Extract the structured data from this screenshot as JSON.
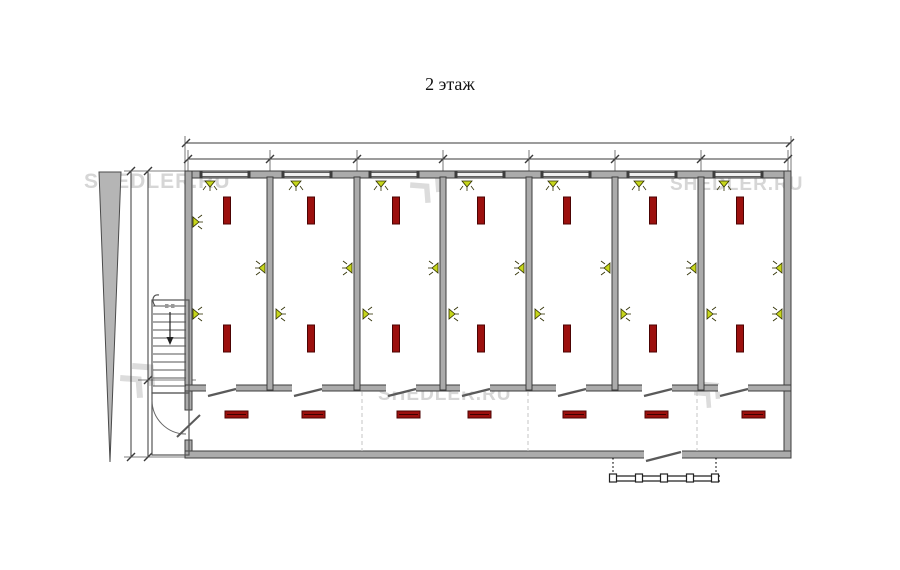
{
  "title": "2 этаж",
  "watermark": {
    "text": "SHEDLER.RU",
    "texts": [
      {
        "x": 84,
        "y": 170,
        "size": 21
      },
      {
        "x": 670,
        "y": 174,
        "size": 19
      },
      {
        "x": 378,
        "y": 384,
        "size": 19
      }
    ],
    "logos": [
      {
        "x": 410,
        "y": 167,
        "size": 36
      },
      {
        "x": 120,
        "y": 358,
        "size": 40
      },
      {
        "x": 694,
        "y": 378,
        "size": 30
      }
    ]
  },
  "colors": {
    "wall_fill": "#ababab",
    "wall_edge": "#3d3d3d",
    "window_fill": "#f0f0f0",
    "radiator": "#9c100e",
    "radiator_edge": "#4c0303",
    "light": "#c6d61c",
    "light_edge": "#2e2e00",
    "dim_line": "#3a3a3a",
    "dashed": "#c6c6c6",
    "watermark": "#d6d6d6"
  },
  "plan": {
    "outer": {
      "left": 185,
      "top": 171,
      "right": 791,
      "bottom": 458,
      "thickness": 7
    },
    "corridor_wall": {
      "y": 385,
      "thickness": 6
    },
    "room_boundaries": [
      188,
      270,
      357,
      443,
      529,
      615,
      701,
      788
    ],
    "divider_walls_x": [
      267,
      354,
      440,
      526,
      612,
      698
    ],
    "left_wall_door": {
      "y1": 410,
      "y2": 440
    },
    "windows_x": [
      202,
      284,
      371,
      457,
      543,
      629,
      715
    ],
    "window_w": 46,
    "corridor_doors_x": [
      206,
      292,
      386,
      460,
      556,
      642,
      718
    ],
    "corridor_door_w": 30,
    "bottom_door": {
      "x": 644,
      "w": 38
    },
    "radiators_vertical": {
      "xs": [
        227,
        311,
        396,
        481,
        567,
        653,
        740
      ],
      "row_y": [
        197,
        325
      ],
      "w": 7,
      "h": 27
    },
    "radiators_horizontal": {
      "xs": [
        225,
        302,
        397,
        468,
        563,
        645,
        742
      ],
      "y": 411,
      "w": 23,
      "h": 7
    },
    "lights": {
      "top_row": {
        "xs": [
          210,
          296,
          381,
          467,
          553,
          639,
          724
        ],
        "y": 181
      },
      "upper_row": {
        "xs": [
          265,
          352,
          438,
          524,
          610,
          696,
          782
        ],
        "y": 268,
        "dir": "left"
      },
      "lower_row": {
        "xs": [
          193,
          276,
          363,
          449,
          535,
          621,
          707
        ],
        "y": 314,
        "dir": "right"
      },
      "left_wall": {
        "x": 193,
        "y": 222,
        "dir": "right"
      },
      "right_wall_lower": {
        "x": 782,
        "y": 314,
        "dir": "left"
      }
    },
    "dashed_x": [
      362,
      528,
      697
    ],
    "stairs": {
      "x1": 152,
      "x2": 189,
      "y1": 300,
      "y2": 393,
      "treads": 11,
      "arrow_x": 170
    },
    "vestibule": {
      "x1": 152,
      "x2": 189,
      "y1": 393,
      "y2": 455
    },
    "porch": {
      "x1": 610,
      "x2": 720,
      "rail_y": 476,
      "posts_x": [
        613,
        639,
        664,
        690,
        715
      ],
      "dotted_x": [
        613,
        716
      ]
    },
    "wedge": {
      "top_x1": 99,
      "top_x2": 121,
      "tip_x": 110,
      "top_y": 172,
      "tip_y": 462
    },
    "dims": {
      "top_line1_y": 143,
      "top_line2_y": 159,
      "left_lineA_x": 131,
      "left_lineB_x": 148,
      "landing_y": 380
    }
  }
}
